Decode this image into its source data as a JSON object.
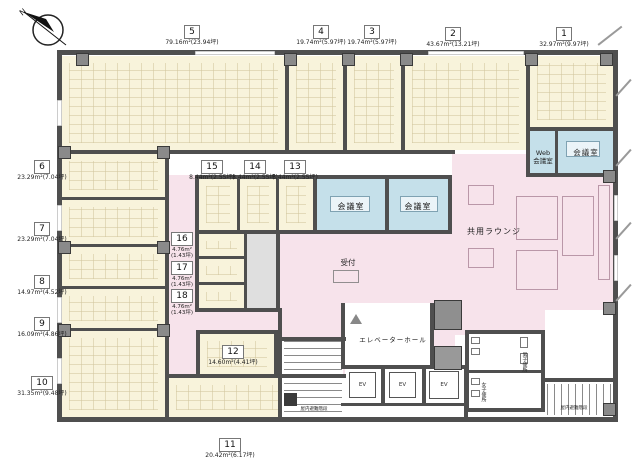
{
  "compass": {
    "north_label": "N"
  },
  "units": {
    "u1": {
      "number": "1",
      "area": "32.97m²(9.97坪)"
    },
    "u2": {
      "number": "2",
      "area": "43.67m²(13.21坪)"
    },
    "u3": {
      "number": "3",
      "area": "19.74m²(5.97坪)"
    },
    "u4": {
      "number": "4",
      "area": "19.74m²(5.97坪)"
    },
    "u5": {
      "number": "5",
      "area": "79.16m²(23.94坪)"
    },
    "u6": {
      "number": "6",
      "area": "23.29m²(7.04坪)"
    },
    "u7": {
      "number": "7",
      "area": "23.29m²(7.04坪)"
    },
    "u8": {
      "number": "8",
      "area": "14.97m²(4.52坪)"
    },
    "u9": {
      "number": "9",
      "area": "16.09m²(4.86坪)"
    },
    "u10": {
      "number": "10",
      "area": "31.35m²(9.48坪)"
    },
    "u11": {
      "number": "11",
      "area": "20.42m²(6.17坪)"
    },
    "u12": {
      "number": "12",
      "area": "14.60m²(4.41坪)"
    },
    "u13": {
      "number": "13",
      "area": "8.44m²(2.55坪)"
    },
    "u14": {
      "number": "14",
      "area": "8.44m²(2.55坪)"
    },
    "u15": {
      "number": "15",
      "area": "8.44m²(2.55坪)"
    },
    "u16": {
      "number": "16",
      "area_line1": "4.76m²",
      "area_line2": "(1.43坪)"
    },
    "u17": {
      "number": "17",
      "area_line1": "4.76m²",
      "area_line2": "(1.43坪)"
    },
    "u18": {
      "number": "18",
      "area_line1": "4.76m²",
      "area_line2": "(1.43坪)"
    }
  },
  "rooms": {
    "meeting_room": "会議室",
    "web_meeting_line1": "Web",
    "web_meeting_line2": "会議室",
    "shared_lounge": "共用ラウンジ",
    "reception": "受付",
    "elevator_hall": "エレベーターホール",
    "elevator": "EV",
    "indoor_escape_stairs": "屋内避難階段",
    "mens_toilet": "男子便所",
    "womens_toilet": "女子便所"
  },
  "colors": {
    "office": "#F8F3DB",
    "meeting_room": "#C5E0EA",
    "common_area": "#F7E3EB",
    "wall": "#4F4F4F"
  }
}
